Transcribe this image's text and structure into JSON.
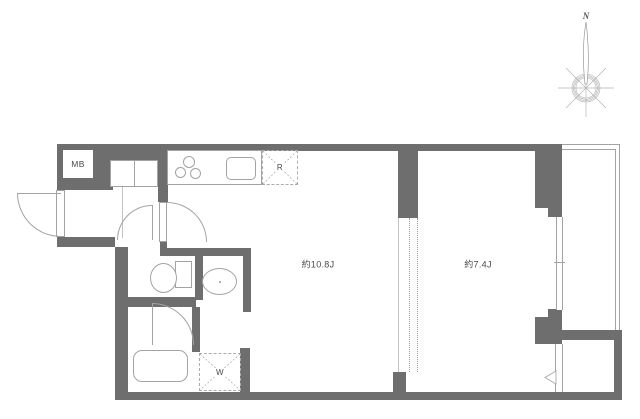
{
  "floor_plan": {
    "rooms": [
      {
        "id": "living-dining-kitchen",
        "size_label": "約10.8J"
      },
      {
        "id": "western-room",
        "size_label": "約7.4J"
      }
    ],
    "labels": {
      "meter_box": "MB",
      "refrigerator_space": "R",
      "washer_space": "W",
      "north": "N"
    },
    "colors": {
      "wall": "#6e6e6e",
      "thin_line": "#a3a3a3",
      "dashed_line": "#ababab",
      "text": "#4a4a4a",
      "background": "#ffffff"
    }
  }
}
